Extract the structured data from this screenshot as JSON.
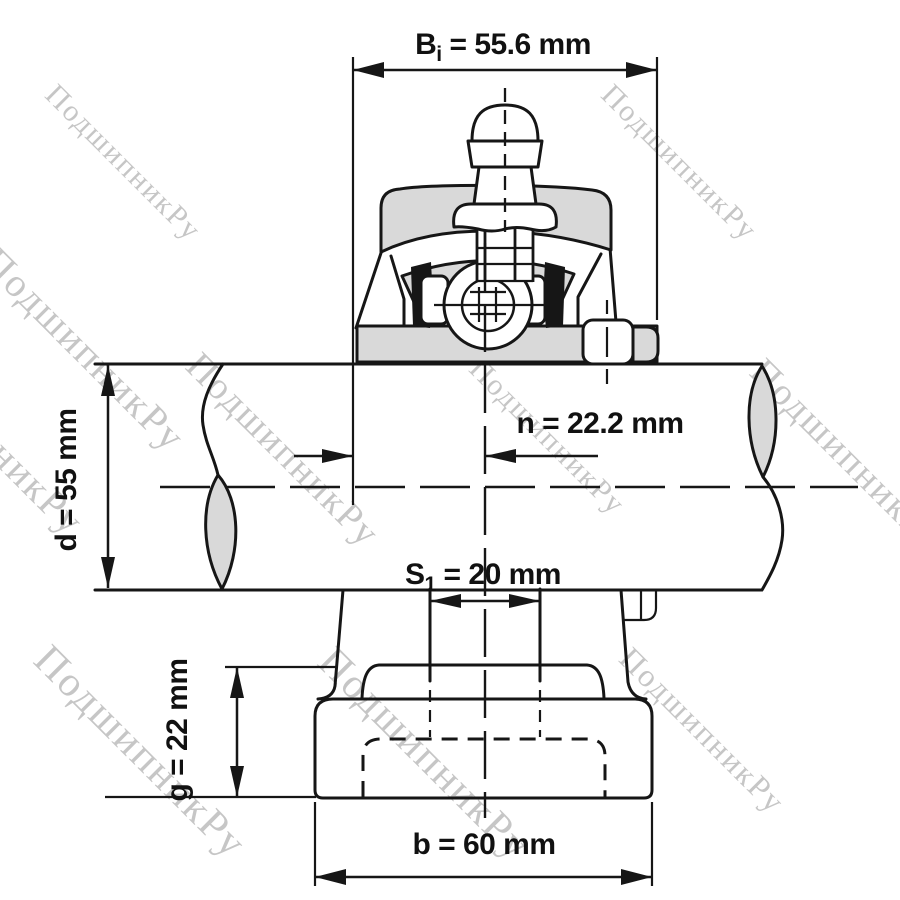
{
  "drawing": {
    "watermark_text": "ПодшипникРу",
    "dimensions": {
      "bi": {
        "prefix": "B",
        "sub": "i",
        "rest": " = 55.6 mm"
      },
      "n": {
        "label": "n = 22.2 mm"
      },
      "d": {
        "label": "d = 55 mm"
      },
      "s1": {
        "prefix": "S",
        "sub": "1",
        "rest": " = 20 mm"
      },
      "g": {
        "label": "g = 22 mm"
      },
      "b": {
        "label": "b = 60 mm"
      }
    },
    "colors": {
      "line": "#161616",
      "part_fill_gray": "#d9d9d9",
      "watermark_gray": "#c6c6c6",
      "background": "#ffffff"
    }
  }
}
